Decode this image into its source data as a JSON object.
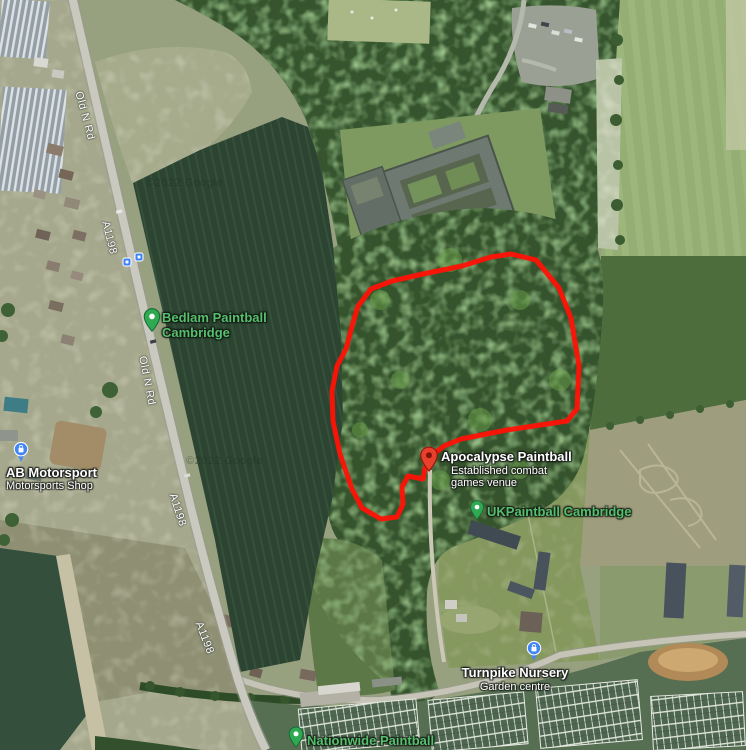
{
  "map": {
    "attribution": "©2022 Google",
    "road_labels": [
      {
        "text": "Old N Rd"
      },
      {
        "text": "A1198"
      },
      {
        "text": "Old N Rd"
      },
      {
        "text": "A1198"
      },
      {
        "text": "A1198"
      }
    ],
    "pois": [
      {
        "name": "Bedlam Paintball Cambridge",
        "type": "green-pin"
      },
      {
        "name": "Apocalypse Paintball",
        "subtitle": "Established combat games venue",
        "type": "red-pin"
      },
      {
        "name": "UKPaintball Cambridge",
        "type": "green-pin"
      },
      {
        "name": "Nationwide Paintball",
        "type": "green-pin"
      },
      {
        "name": "Turnpike Nursery",
        "subtitle": "Garden centre",
        "type": "blue-shopping-pin"
      },
      {
        "name": "AB Motorsport",
        "subtitle": "Motorsports Shop",
        "type": "blue-shopping-pin"
      }
    ],
    "annotation": {
      "path": "M352,489 L340,454 L333,421 L332,391 L337,366 L346,349 L352,326 L358,306 L371,289 L392,281 L423,274 L462,266 L491,257 L511,254 L536,260 L559,288 L571,318 L579,366 L577,409 L567,421 L534,426 L507,430 L461,439 L444,446 L431,456 L425,468 L423,479 L408,476 L402,487 L403,504 L397,517 L381,519 L362,508 Z"
    },
    "colors": {
      "route_red": "#ff1206",
      "label_green": "#55c06c",
      "label_white": "#ffffff",
      "pin_green": "#2fa952",
      "pin_red": "#e8402a",
      "pin_blue": "#4285f4",
      "bus_blue": "#3e82f7"
    }
  }
}
